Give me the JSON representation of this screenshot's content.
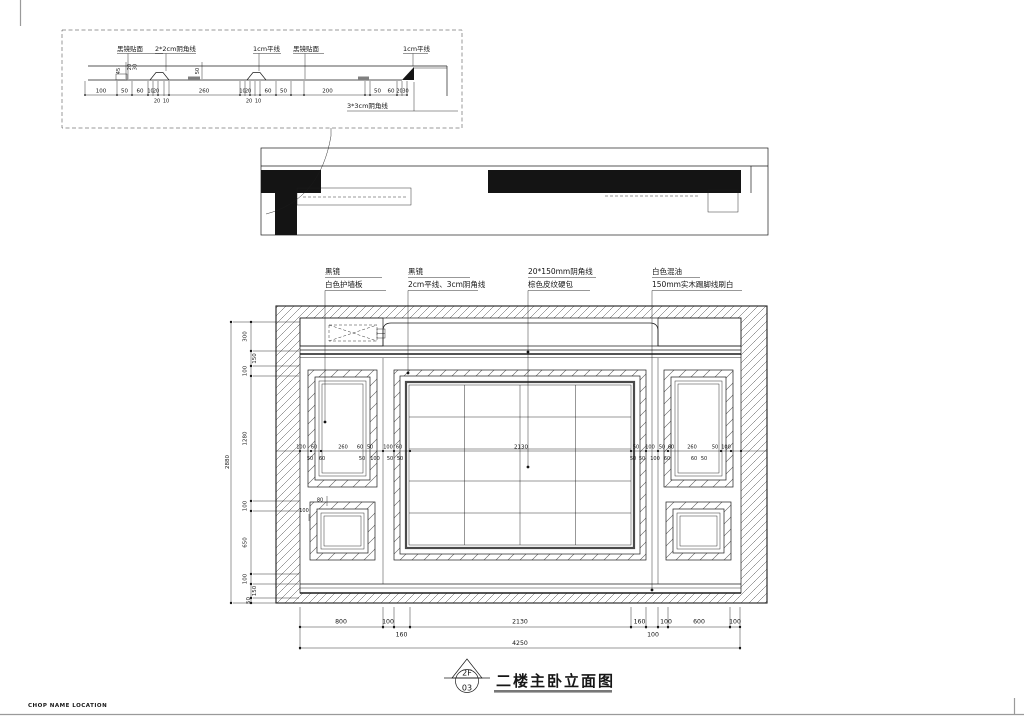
{
  "colors": {
    "ink": "#1c1c1c",
    "paper": "#ffffff",
    "veneer_gray": "#808080",
    "title_rule_gray": "#777777"
  },
  "sheet": {
    "footer_note": "CHOP NAME LOCATION"
  },
  "title_block": {
    "marker_level": "2F",
    "marker_number": "03",
    "title": "二楼主卧立面图"
  },
  "detail_section": {
    "callouts": [
      "黑镜贴面",
      "2*2cm阴角线",
      "1cm平线",
      "黑镜贴面",
      "1cm平线",
      "3*3cm阴角线"
    ],
    "dims_above": [
      "100",
      "50",
      "60",
      "10",
      "20",
      "260",
      "10",
      "20",
      "60",
      "50",
      "200",
      "50",
      "60",
      "20",
      "30"
    ],
    "dims_below": [
      "20",
      "10",
      "20",
      "10"
    ],
    "dims_vertical": [
      "45",
      "20",
      "30",
      "50"
    ]
  },
  "elevation": {
    "callouts": [
      {
        "line1": "黑镜",
        "line2": "白色护墙板"
      },
      {
        "line1": "黑镜",
        "line2": "2cm平线、3cm阴角线"
      },
      {
        "line1": "20*150mm阴角线",
        "line2": "棕色皮纹硬包"
      },
      {
        "line1": "白色混油",
        "line2": "150mm实木踢脚线刷白"
      }
    ],
    "dims_left_chain": [
      "300",
      "150",
      "100",
      "1280",
      "100",
      "650",
      "100",
      "150",
      "50"
    ],
    "dim_left_total": "2880",
    "dims_bottom_chain": [
      "800",
      "100",
      "160",
      "2130",
      "160",
      "100",
      "100",
      "600",
      "100"
    ],
    "dim_bottom_total": "4250",
    "dims_mid_left_above": [
      "100",
      "60",
      "260",
      "60",
      "50",
      "100",
      "60"
    ],
    "dims_mid_left_below": [
      "50",
      "60",
      "50",
      "100",
      "50",
      "50"
    ],
    "dim_mid_center": "2130",
    "dims_mid_right_above": [
      "50",
      "100",
      "50",
      "60",
      "260",
      "50",
      "100"
    ],
    "dims_mid_right_below": [
      "50",
      "50",
      "100",
      "60",
      "60",
      "50"
    ],
    "dims_detail_small": [
      "100",
      "80"
    ]
  }
}
